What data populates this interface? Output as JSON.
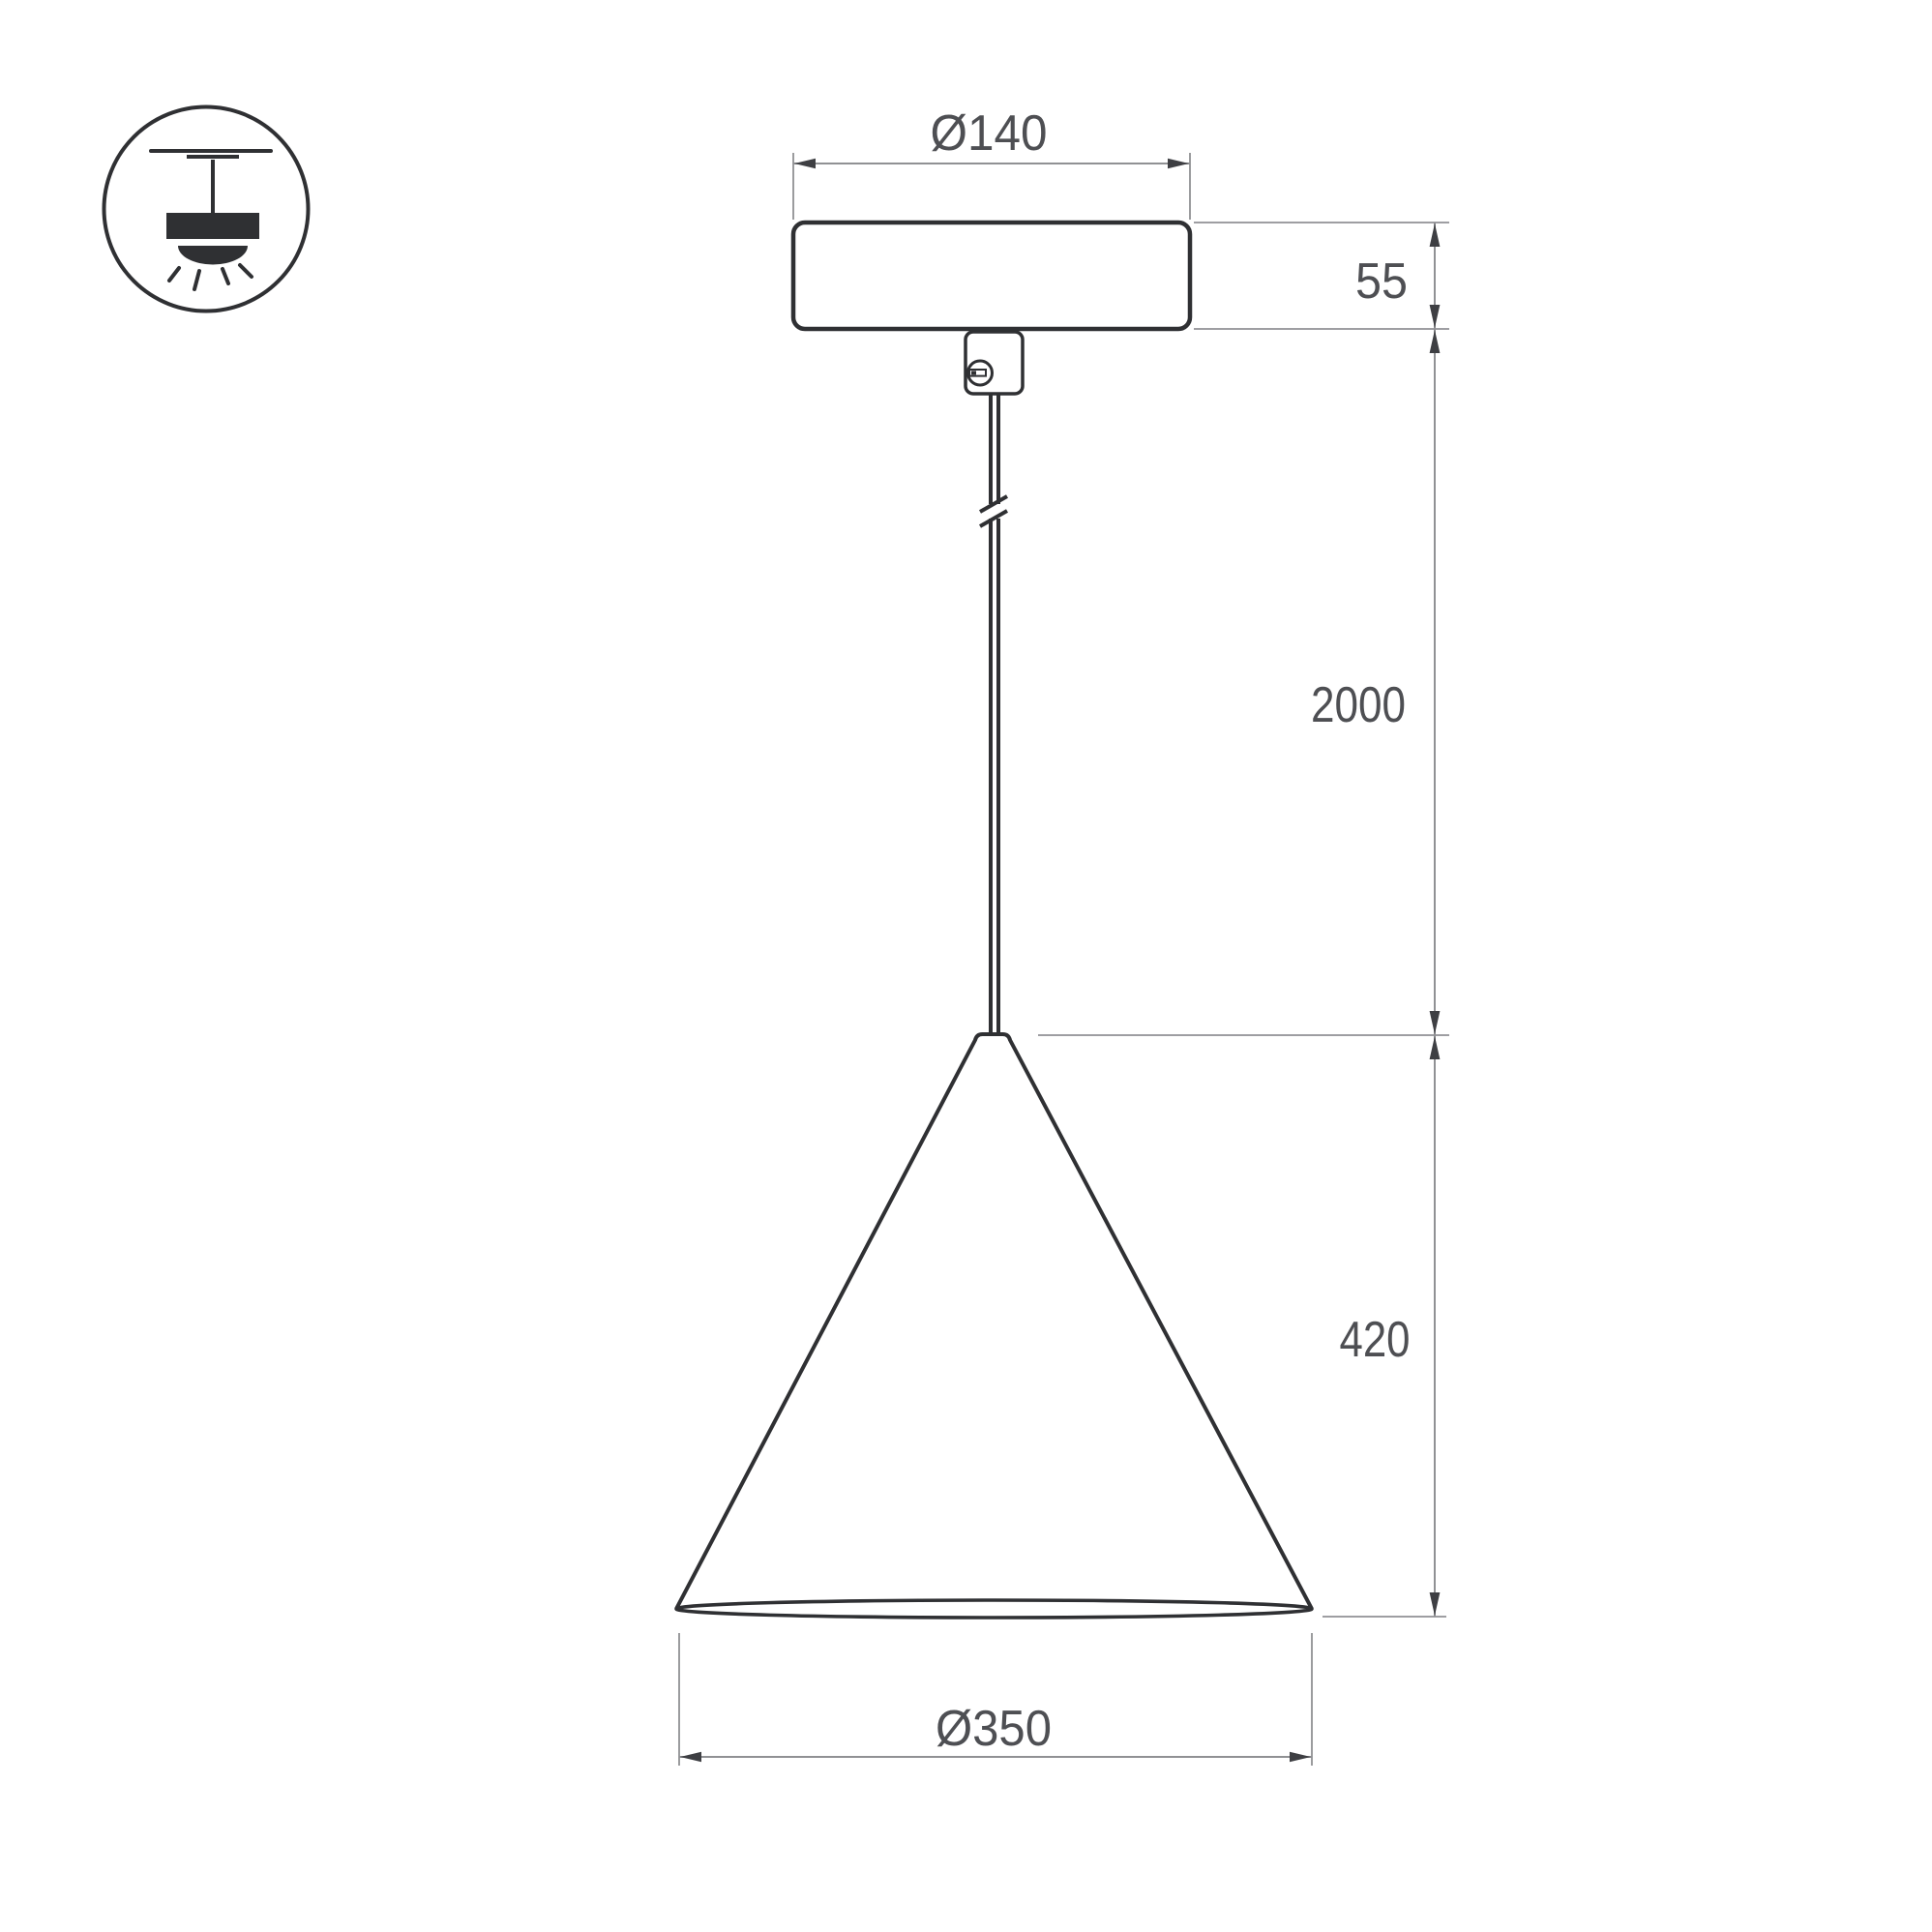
{
  "legend": {
    "icon": "pendant-lamp-mount-icon"
  },
  "dimensions": {
    "canopy_diameter": "Ø140",
    "canopy_height": "55",
    "suspension_length": "2000",
    "shade_height": "420",
    "shade_diameter": "Ø350"
  },
  "colors": {
    "object_line": "#2f3033",
    "dimension_line": "#909194",
    "arrow": "#3e3f43",
    "text_color": "#4e4f53",
    "background": "#ffffff"
  }
}
